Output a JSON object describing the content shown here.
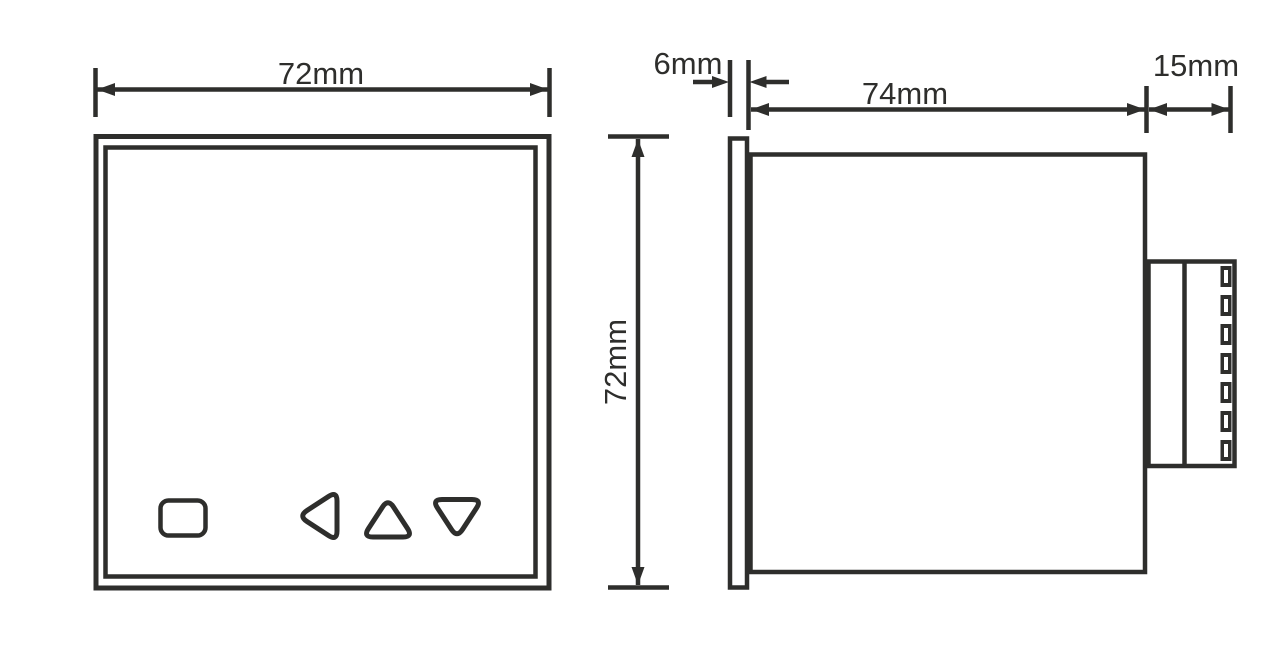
{
  "dimensions": {
    "front_width": "72mm",
    "front_height": "72mm",
    "bezel_depth": "6mm",
    "body_depth": "74mm",
    "terminal_depth": "15mm"
  },
  "front_view": {
    "buttons": [
      "square-button",
      "left-arrow-button",
      "up-arrow-button",
      "down-arrow-button"
    ]
  },
  "side_view": {
    "terminal_count": 7
  },
  "colors": {
    "line": "#2e2e2c",
    "background": "#ffffff"
  }
}
